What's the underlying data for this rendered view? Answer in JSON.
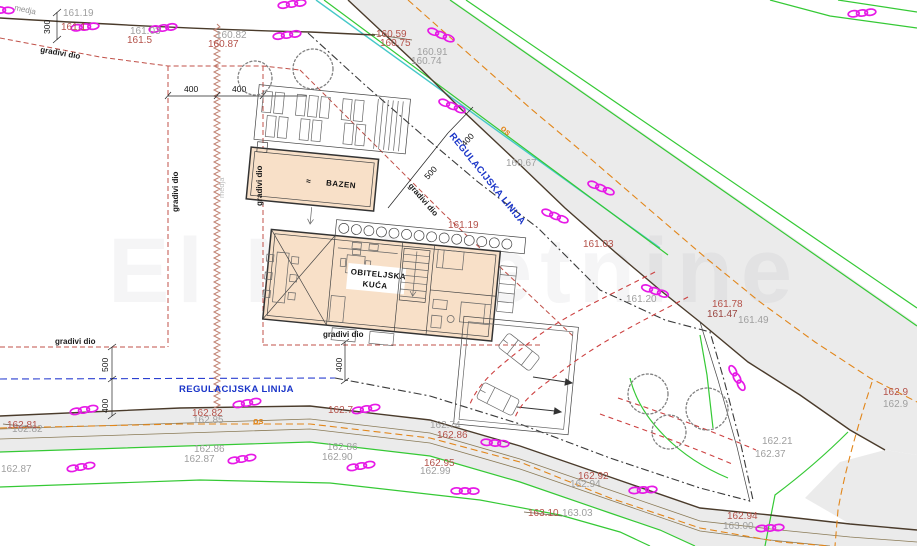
{
  "watermark": "El Nekretnine",
  "texts": {
    "medja": "medja",
    "gradivi_dio": "gradivi dio",
    "regulacijska": "REGULACIJSKA LINIJA",
    "os": "os",
    "bazen": "BAZEN",
    "obiteljska": "OBITELJSKA",
    "kuca": "KUĆA",
    "wave": "≈"
  },
  "dims": {
    "d300": "300",
    "d400": "400",
    "d500": "500"
  },
  "elev_gray": [
    "161.19",
    "161.03",
    "160.82",
    "160.91",
    "160.74",
    "160.67",
    "161.20",
    "161.49",
    "162.82",
    "162.87",
    "162.85",
    "162.86",
    "162.87",
    "162.86",
    "162.90",
    "162.74",
    "162.99",
    "162.94",
    "163.03",
    "163.00",
    "162.21",
    "162.37",
    "162.9"
  ],
  "elev_red": [
    "161.1",
    "161.5",
    "160.87",
    "160.59",
    "160.75",
    "161.03",
    "161.78",
    "161.47",
    "161.19",
    "162.81",
    "162.82",
    "162.7",
    "162.95",
    "162.92",
    "163.10",
    "162.94",
    "162.9",
    "162.86"
  ],
  "colors": {
    "magenta": "#e61ae6",
    "green": "#35c935",
    "cyan": "#45c8c8",
    "orange": "#e2861a",
    "blue": "#1a35c8",
    "red_label": "#b4524a",
    "gray_label": "#9f9f9f",
    "envelope_red": "#c05048",
    "house_fill": "#f8e0c8",
    "road_fill": "#ebebeb"
  }
}
